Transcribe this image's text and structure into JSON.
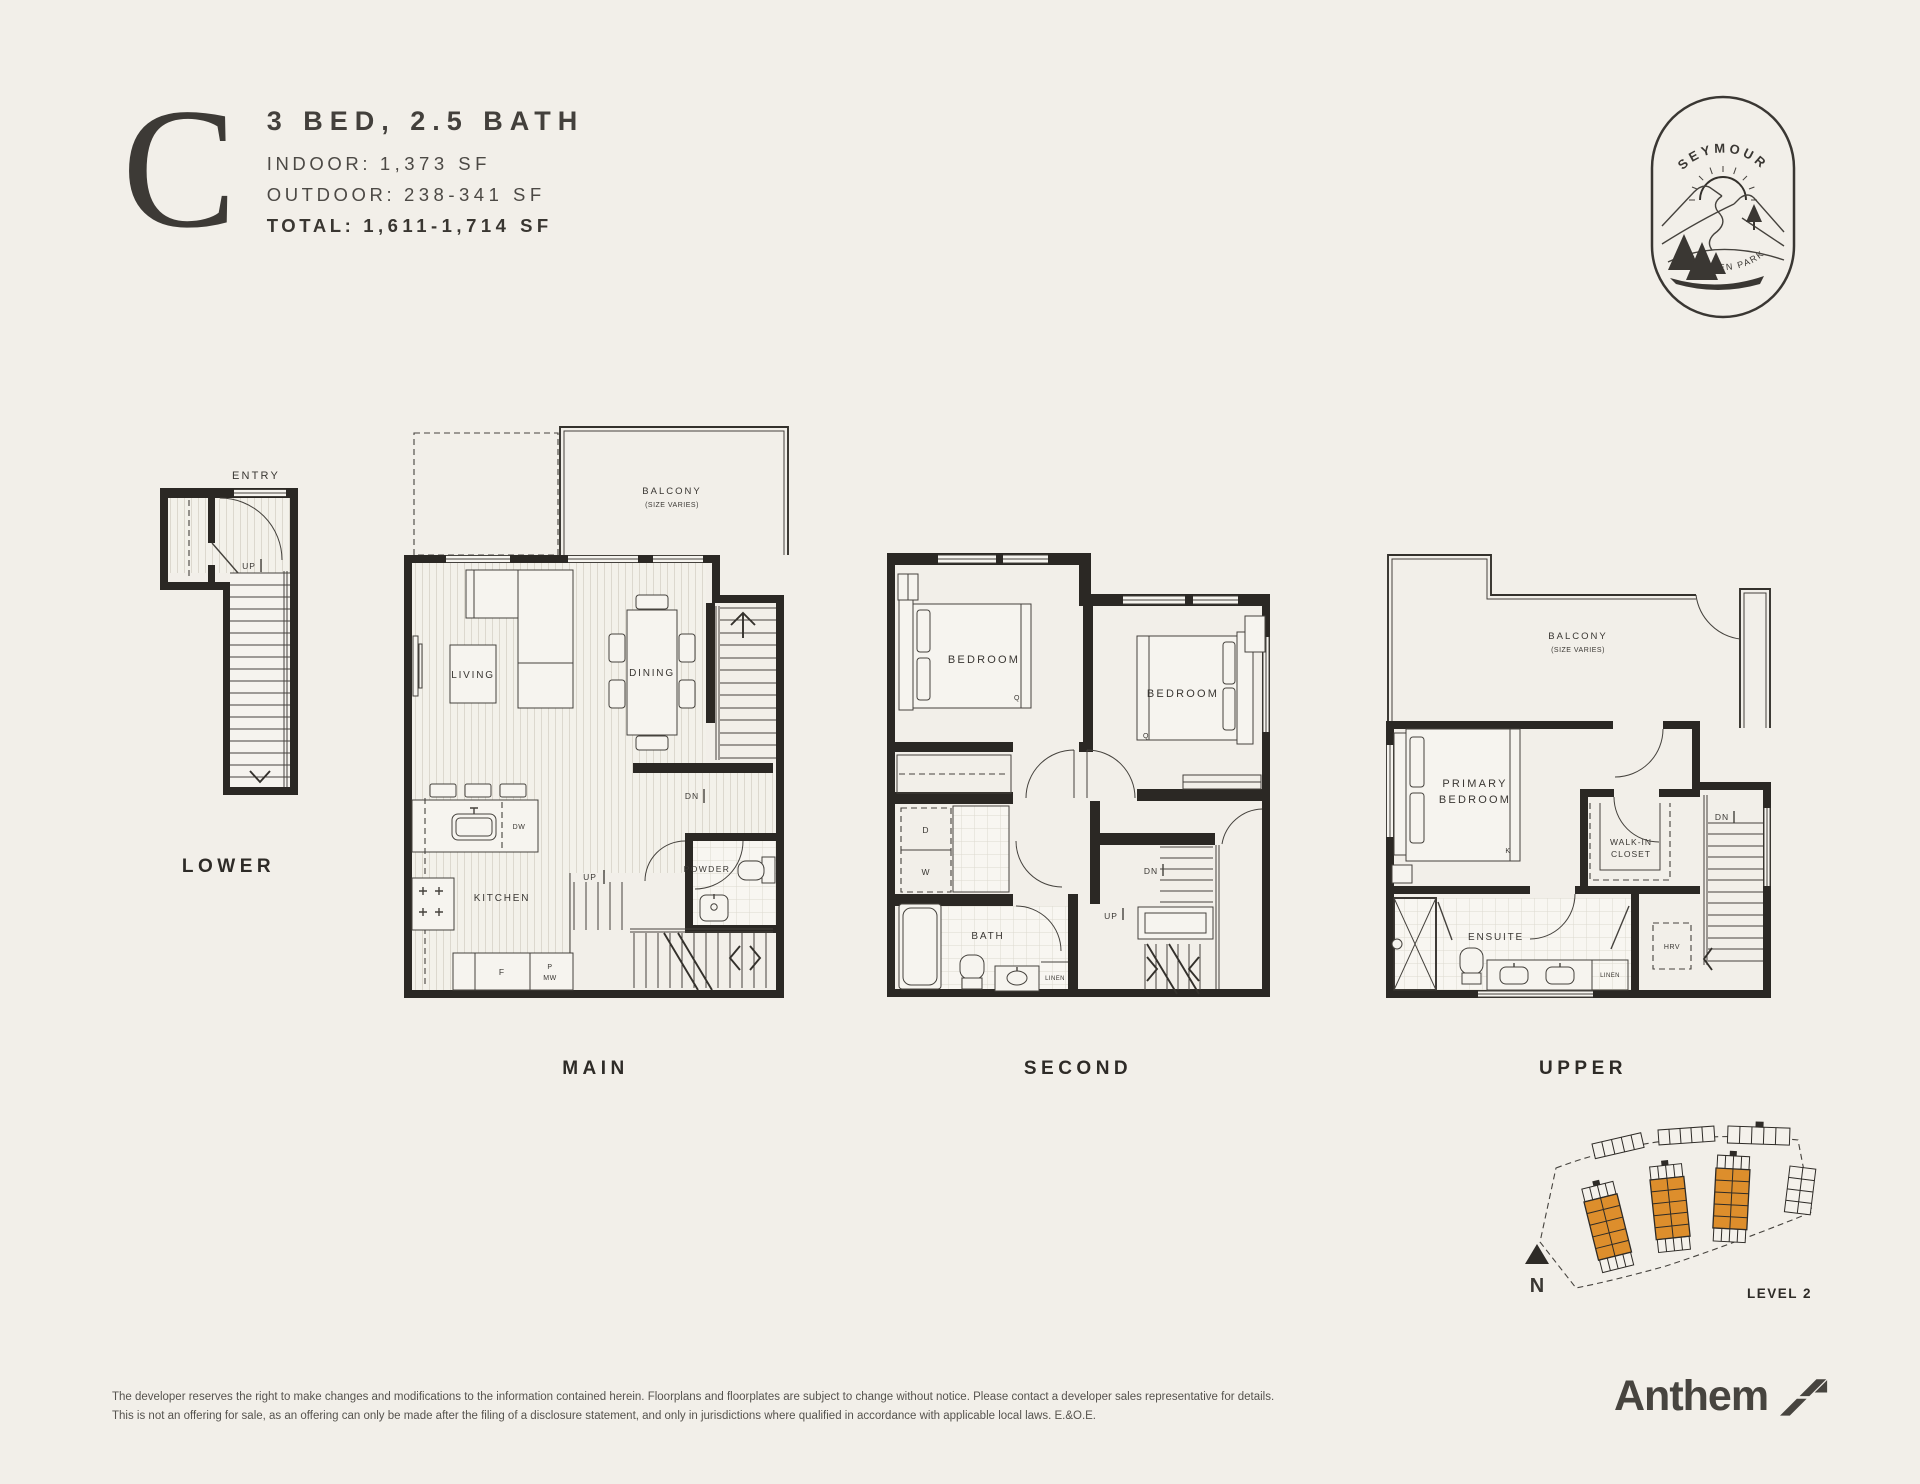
{
  "colors": {
    "background": "#F2EFE9",
    "ink": "#2B2824",
    "accent_orange": "#DD8E2C"
  },
  "header": {
    "plan_letter": "C",
    "plan_title": "3 BED, 2.5 BATH",
    "indoor_label": "INDOOR:",
    "indoor_value": "1,373 SF",
    "outdoor_label": "OUTDOOR:",
    "outdoor_value": "238-341 SF",
    "total_label": "TOTAL:",
    "total_value": "1,611-1,714 SF"
  },
  "badge": {
    "top_text": "SEYMOUR",
    "bottom_text": "AT BADEN PARK"
  },
  "floors": {
    "lower": {
      "name": "LOWER",
      "entry_label": "ENTRY",
      "up_label": "UP"
    },
    "main": {
      "name": "MAIN",
      "balcony_label": "BALCONY",
      "balcony_sub": "(SIZE VARIES)",
      "living_label": "LIVING",
      "dining_label": "DINING",
      "kitchen_label": "KITCHEN",
      "powder_label": "POWDER",
      "dishwasher_label": "DW",
      "fridge_label": "F",
      "pantry_label": "P",
      "microwave_label": "MW",
      "up_label": "UP",
      "down_label": "DN"
    },
    "second": {
      "name": "SECOND",
      "bedroom_left_label": "BEDROOM",
      "bedroom_left_bed": "Q",
      "bedroom_right_label": "BEDROOM",
      "bedroom_right_bed": "Q",
      "bath_label": "BATH",
      "linen_label": "LINEN",
      "dryer_label": "D",
      "washer_label": "W",
      "up_label": "UP",
      "down_label": "DN"
    },
    "upper": {
      "name": "UPPER",
      "balcony_label": "BALCONY",
      "balcony_sub": "(SIZE VARIES)",
      "primary_line1": "PRIMARY",
      "primary_line2": "BEDROOM",
      "bed": "K",
      "closet_line1": "WALK-IN",
      "closet_line2": "CLOSET",
      "ensuite_label": "ENSUITE",
      "linen_label": "LINEN",
      "hrv_label": "HRV",
      "down_label": "DN"
    }
  },
  "site_plan": {
    "level_label": "LEVEL 2",
    "compass_label": "N"
  },
  "footer": {
    "disclaimer_line1": "The developer reserves the right to make changes and modifications to the information contained herein. Floorplans and floorplates are subject to change without notice. Please contact a developer sales representative for details.",
    "disclaimer_line2": "This is not an offering for sale, as an offering can only be made after the filing of a disclosure statement, and only in jurisdictions where qualified in accordance with applicable local laws. E.&O.E.",
    "brand": "Anthem"
  }
}
